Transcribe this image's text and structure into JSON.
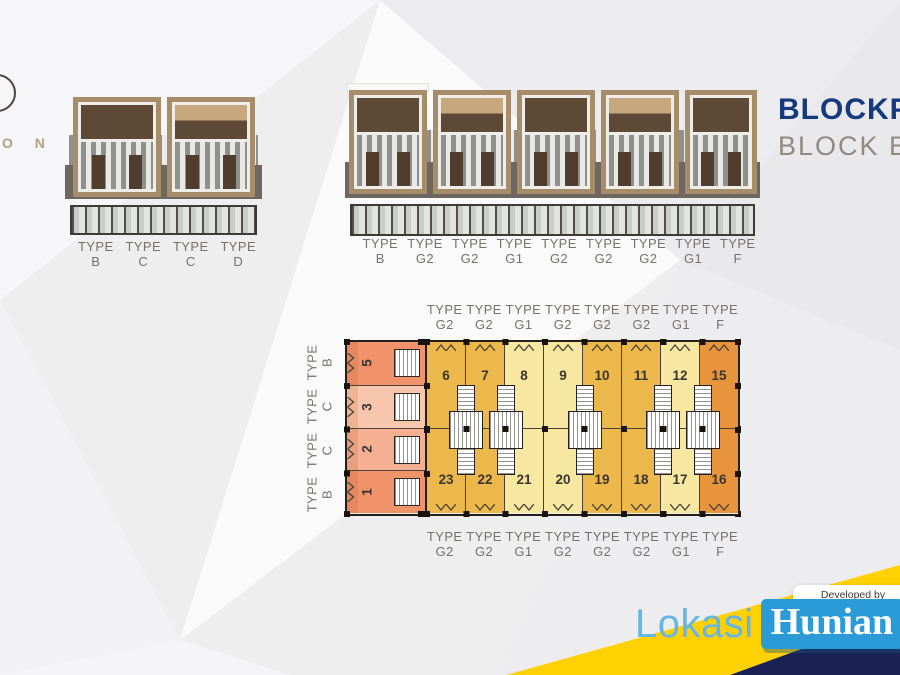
{
  "labels": {
    "type_word": "TYPE"
  },
  "brand": {
    "partial_name": "O N"
  },
  "header": {
    "title": "BLOCKPLAN",
    "subtitle": "BLOCK B"
  },
  "elevations": {
    "left_types": [
      "B",
      "C",
      "C",
      "D"
    ],
    "right_types": [
      "B",
      "G2",
      "G2",
      "G1",
      "G2",
      "G2",
      "G2",
      "G1",
      "F"
    ]
  },
  "plan": {
    "column_types_top": [
      "G2",
      "G2",
      "G1",
      "G2",
      "G2",
      "G2",
      "G1",
      "F"
    ],
    "column_types_bottom": [
      "G2",
      "G2",
      "G1",
      "G2",
      "G2",
      "G2",
      "G1",
      "F"
    ],
    "row_types_side": [
      "B",
      "C",
      "C",
      "B"
    ],
    "left_units": [
      {
        "num": "5",
        "color": "#F0936B"
      },
      {
        "num": "3",
        "color": "#F8C7AD"
      },
      {
        "num": "2",
        "color": "#F5AF92"
      },
      {
        "num": "1",
        "color": "#F0936B"
      }
    ],
    "top_row_units": [
      {
        "num": "6",
        "color": "#ECB84C"
      },
      {
        "num": "7",
        "color": "#ECB84C"
      },
      {
        "num": "8",
        "color": "#F8E7A0"
      },
      {
        "num": "9",
        "color": "#F8E7A0"
      },
      {
        "num": "10",
        "color": "#ECB84C"
      },
      {
        "num": "11",
        "color": "#ECB84C"
      },
      {
        "num": "12",
        "color": "#F8E7A0"
      },
      {
        "num": "15",
        "color": "#E8943C"
      }
    ],
    "bottom_row_units": [
      {
        "num": "23",
        "color": "#ECB84C"
      },
      {
        "num": "22",
        "color": "#ECB84C"
      },
      {
        "num": "21",
        "color": "#F8E7A0"
      },
      {
        "num": "20",
        "color": "#F8E7A0"
      },
      {
        "num": "19",
        "color": "#ECB84C"
      },
      {
        "num": "18",
        "color": "#ECB84C"
      },
      {
        "num": "17",
        "color": "#F8E7A0"
      },
      {
        "num": "16",
        "color": "#E8943C"
      }
    ]
  },
  "footer": {
    "lokasi": "Lokasi",
    "hunian": "Hunian",
    "developed_by": "Developed by",
    "dev_logo_letters": [
      {
        "ch": "A",
        "color": "#2FB3A6"
      },
      {
        "ch": "R",
        "color": "#A9ABAE"
      },
      {
        "ch": "A",
        "color": "#F5A623"
      },
      {
        "ch": "R",
        "color": "#A9ABAE"
      },
      {
        "ch": "A",
        "color": "#2FB3A6"
      },
      {
        "ch": "S",
        "color": "#F5A623"
      }
    ],
    "dev_tagline": "FUN ALL DAY"
  },
  "colors": {
    "title_blue": "#15397F",
    "subtitle_gray": "#8F8A82",
    "accent_yellow": "#FFD100",
    "accent_navy": "#1A2155",
    "lokasi_blue": "#64B6E4",
    "hunian_box_blue": "#2B9BD7"
  }
}
